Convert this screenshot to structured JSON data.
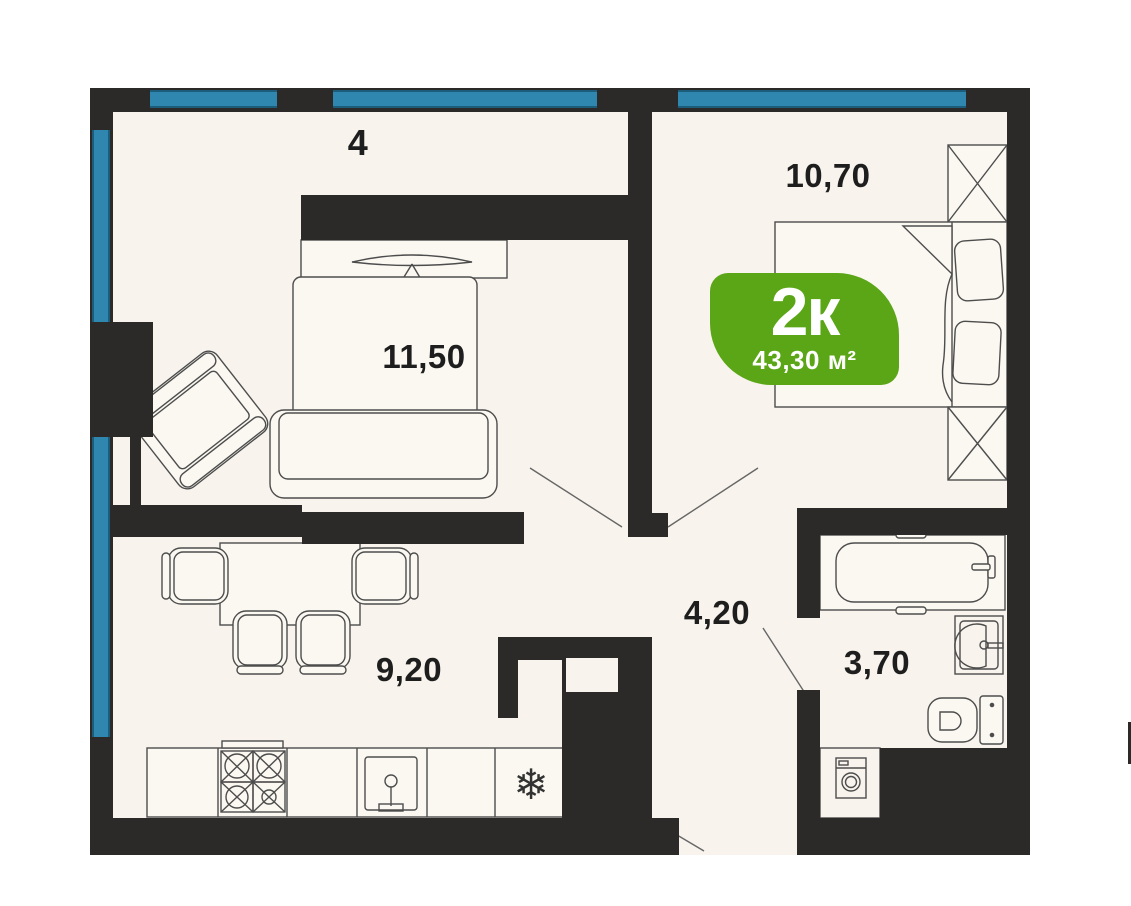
{
  "plan": {
    "title": "2-room apartment floor plan",
    "badge": {
      "rooms": "2к",
      "area": "43,30 м²",
      "color": "#5aa616"
    },
    "labels": {
      "unit": "4",
      "living": "11,50",
      "bedroom": "10,70",
      "kitchen": "9,20",
      "hall": "4,20",
      "bathroom": "3,70"
    },
    "icons": {
      "fridge": "❄"
    },
    "colors": {
      "wall": "#2b2a28",
      "window": "#2f87af",
      "window_edge": "#1d5d7c",
      "floor": "#f8f3ec",
      "furniture_line": "#4d4d4d"
    }
  }
}
